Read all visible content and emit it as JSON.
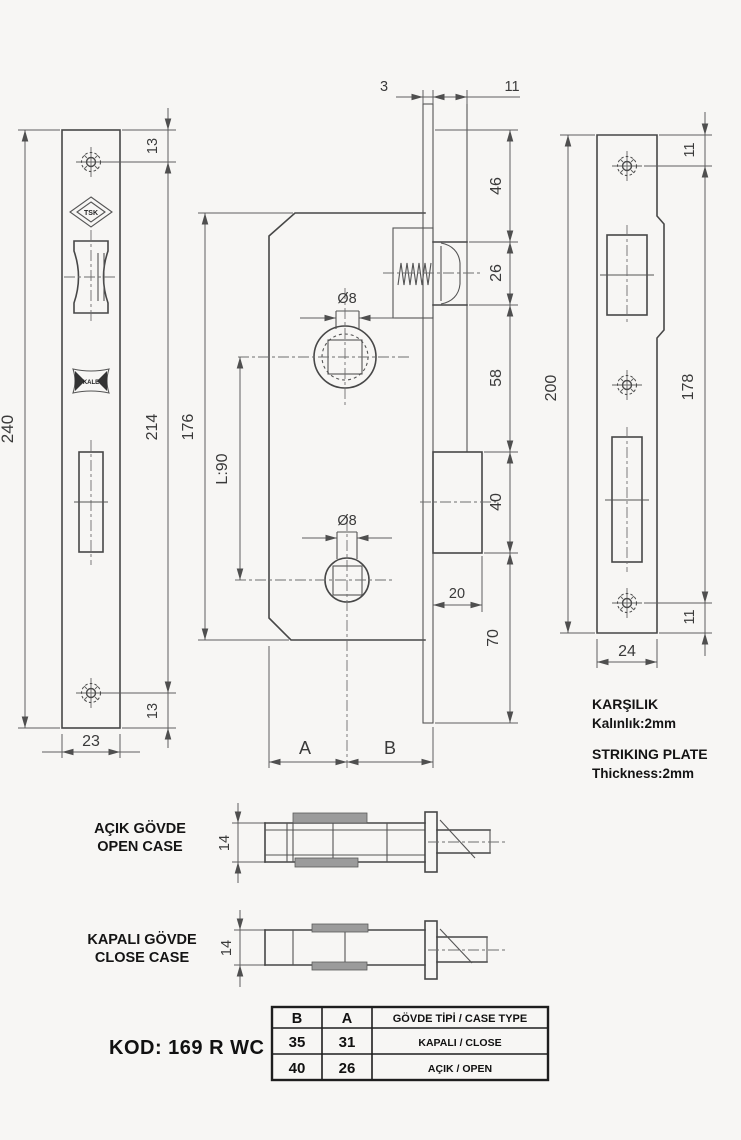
{
  "colors": {
    "background": "#f7f6f4",
    "line": "#474747",
    "dim": "#5f5f5f",
    "text": "#1c1c1c",
    "shade": "#9b9b9b"
  },
  "left_plate": {
    "logo_tsk": "TSK",
    "logo_kale": "KALE",
    "dim_total_height": "240",
    "dim_screw_spacing": "214",
    "dim_screw_top": "13",
    "dim_screw_bottom": "13",
    "dim_width": "23"
  },
  "lock_body": {
    "dim_faceplate_thickness": "3",
    "dim_lip": "11",
    "dim_top_to_latch": "46",
    "dim_latch_height": "26",
    "dim_latch_to_bolt": "58",
    "dim_bolt_height": "40",
    "dim_bolt_throw": "20",
    "dim_bolt_to_bottom": "70",
    "dim_body_height": "176",
    "dim_spindle_spacing": "L:90",
    "dim_spindle_hole": "Ø8",
    "dim_lower_hole": "Ø8",
    "dim_backset_a": "A",
    "dim_backset_b": "B"
  },
  "striking_plate": {
    "dim_height": "200",
    "dim_screw_spacing": "178",
    "dim_screw_top": "11",
    "dim_screw_bottom": "11",
    "dim_width": "24",
    "caption_tr_title": "KARŞILIK",
    "caption_tr_sub": "Kalınlık:2mm",
    "caption_en_title": "STRIKING PLATE",
    "caption_en_sub": "Thickness:2mm"
  },
  "open_case": {
    "label_tr": "AÇIK GÖVDE",
    "label_en": "OPEN CASE",
    "dim_thickness": "14"
  },
  "close_case": {
    "label_tr": "KAPALI GÖVDE",
    "label_en": "CLOSE CASE",
    "dim_thickness": "14"
  },
  "product": {
    "code_label": "KOD: 169 R WC"
  },
  "spec_table": {
    "headers": [
      "B",
      "A",
      "GÖVDE TİPİ / CASE TYPE"
    ],
    "rows": [
      [
        "35",
        "31",
        "KAPALI / CLOSE"
      ],
      [
        "40",
        "26",
        "AÇIK / OPEN"
      ]
    ]
  }
}
